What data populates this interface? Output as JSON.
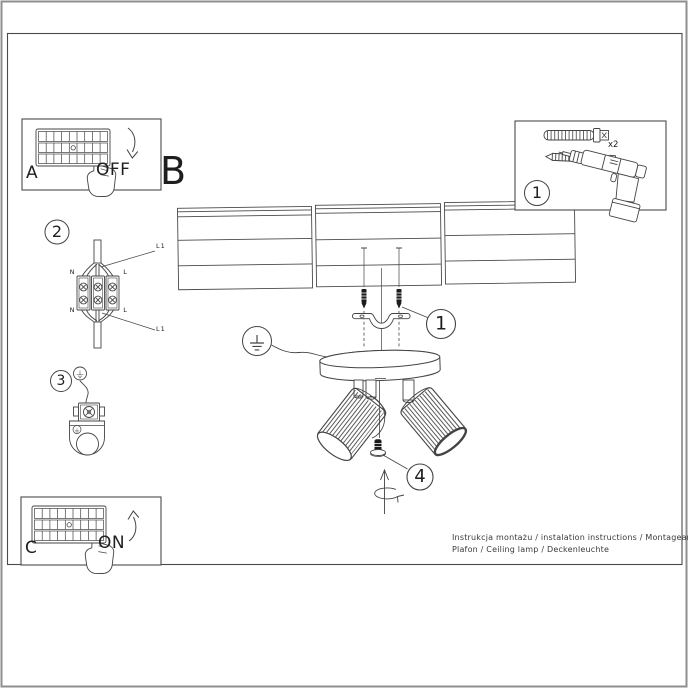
{
  "labels": {
    "a": "A",
    "b": "B",
    "c": "C",
    "off": "OFF",
    "on": "ON"
  },
  "markers": {
    "kit": "1",
    "mount": "1",
    "wiring": "2",
    "ground": "3",
    "adjust": "4"
  },
  "kit": {
    "dowel_qty": "x2"
  },
  "wiring": {
    "n_top": "N",
    "l_top": "L",
    "n_bottom": "N",
    "l_bottom": "L",
    "l1_top": "L1",
    "l1_bottom": "L1"
  },
  "footer": {
    "line1": "Instrukcja montażu / instalation instructions / Montageanleitung",
    "line2": "Plafon / Ceiling lamp / Deckenleuchte"
  },
  "colors": {
    "line": "#444444",
    "frame": "#4a4a4a",
    "outer_border": "#8f8f8f",
    "background": "#ffffff"
  }
}
